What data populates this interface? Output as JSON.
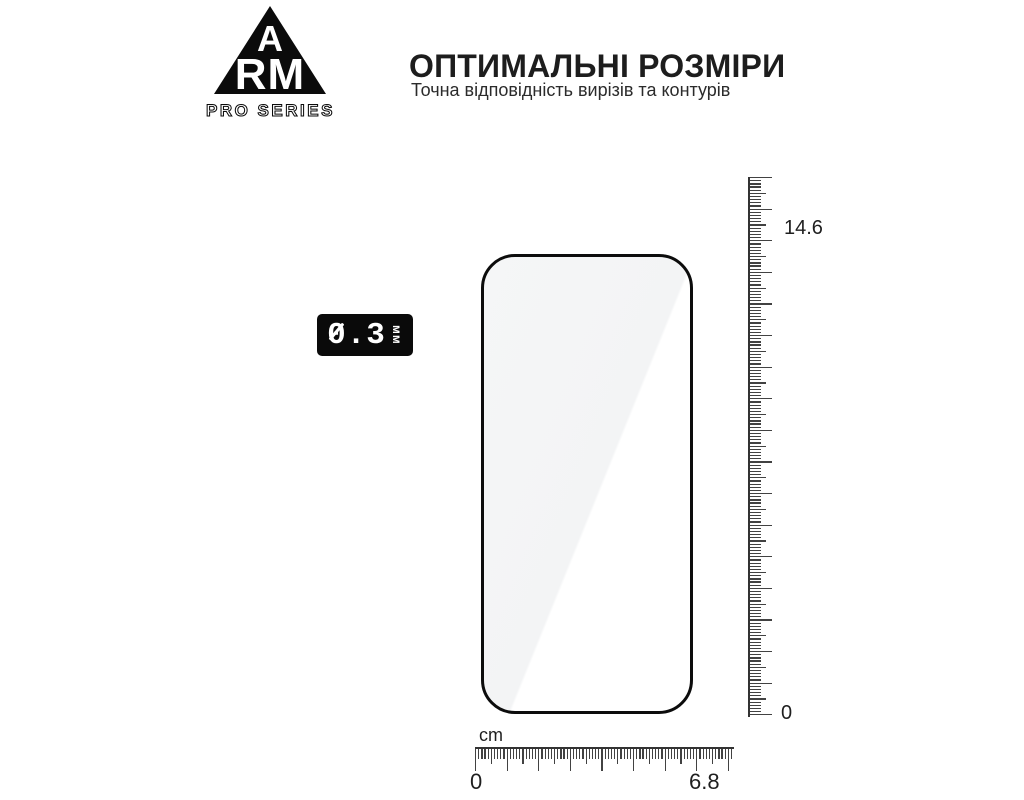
{
  "brand": {
    "triangle_letter_top": "A",
    "triangle_letters_bottom": "RM",
    "series_label": "PRO SERIES"
  },
  "heading": {
    "title": "ОПТИМАЛЬНІ РОЗМІРИ",
    "subtitle": "Точна відповідність вирізів та контурів"
  },
  "thickness_badge": {
    "value": "0.3",
    "unit": "мм"
  },
  "rulers": {
    "vertical": {
      "top_label": "14.6",
      "bottom_label": "0"
    },
    "horizontal": {
      "unit": "cm",
      "left_label": "0",
      "right_label": "6.8"
    }
  },
  "colors": {
    "ink": "#0b0b0b",
    "tick_gray": "#424242",
    "glass_sheen": "#f4f5f6",
    "text": "#1d1d1d"
  }
}
